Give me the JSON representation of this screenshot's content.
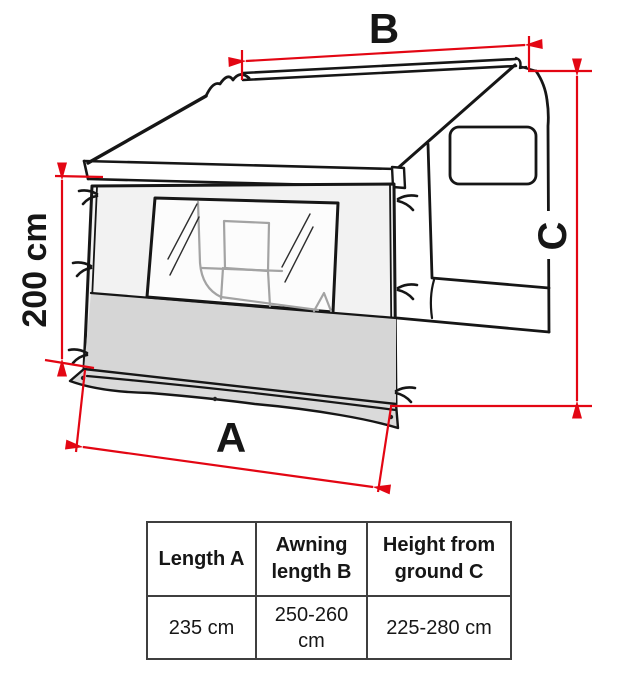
{
  "diagram": {
    "labels": {
      "awning_length": "B",
      "height_from_ground": "C",
      "panel_length": "A",
      "panel_height": "200 cm"
    },
    "colors": {
      "dimension_red": "#e30613",
      "line_black": "#161616",
      "panel_gray": "#d6d6d6"
    }
  },
  "table": {
    "headers": [
      "Length A",
      "Awning length B",
      "Height from ground C"
    ],
    "values": [
      "235 cm",
      "250-260 cm",
      "225-280 cm"
    ]
  }
}
